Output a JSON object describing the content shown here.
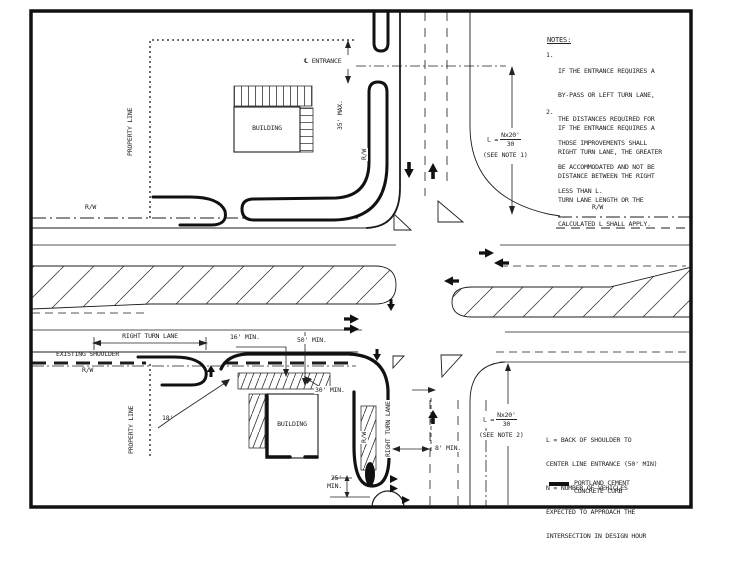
{
  "colors": {
    "ink": "#1c1c1c",
    "background": "#ffffff"
  },
  "notes": {
    "title": "NOTES:",
    "items": [
      {
        "num": "1.",
        "lines": [
          "IF THE ENTRANCE REQUIRES A",
          "BY-PASS OR LEFT TURN LANE,",
          "THE DISTANCES REQUIRED FOR",
          "THOSE IMPROVEMENTS SHALL",
          "BE ACCOMMODATED AND NOT BE",
          "LESS THAN L."
        ]
      },
      {
        "num": "2.",
        "lines": [
          "IF THE ENTRANCE REQUIRES A",
          "RIGHT TURN LANE, THE GREATER",
          "DISTANCE BETWEEN THE RIGHT",
          "TURN LANE LENGTH OR THE",
          "CALCULATED L SHALL APPLY."
        ]
      }
    ]
  },
  "legend": {
    "definitions": [
      "L = BACK OF SHOULDER TO",
      "CENTER LINE ENTRANCE (50' MIN)",
      "N = NUMBER OF VEHICLES",
      "EXPECTED TO APPROACH THE",
      "INTERSECTION IN DESIGN HOUR"
    ],
    "curb_line1": "PORTLAND CEMENT",
    "curb_line2": "CONCRETE CURB"
  },
  "formulas": {
    "l1": {
      "prefix": "L =",
      "numerator": "Nx20'",
      "denominator": "30",
      "ref": "(SEE NOTE 1)"
    },
    "l2": {
      "prefix": "L =",
      "numerator": "Nx20'",
      "denominator": "30",
      "ref": "(SEE NOTE 2)"
    }
  },
  "labels": {
    "cl_symbol": "℄",
    "entrance": "ENTRANCE",
    "max35": "35' MAX.",
    "rw": "R/W",
    "property_line": "PROPERTY LINE",
    "building": "BUILDING",
    "right_turn_lane": "RIGHT TURN LANE",
    "existing_shoulder": "EXISTING SHOULDER",
    "min16": "16' MIN.",
    "min50": "50' MIN.",
    "min30": "30' MIN.",
    "r18": "18'",
    "min8": "8' MIN.",
    "min25_a": "25'",
    "min25_b": "MIN."
  }
}
